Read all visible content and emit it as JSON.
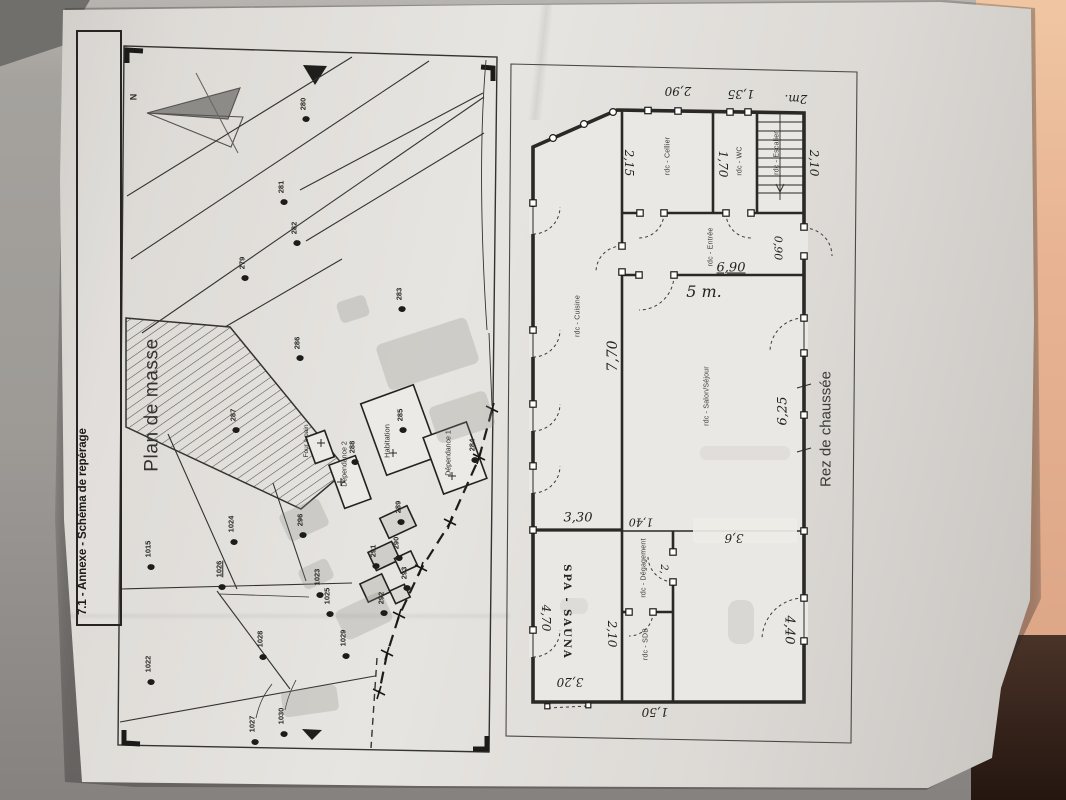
{
  "document": {
    "title": "7.1 - Annexe - Schéma de repérage"
  },
  "site_plan": {
    "title": "Plan de masse",
    "north_label": "N",
    "building_labels": [
      {
        "text": "Four à pain",
        "x": 307,
        "y": 441,
        "size": 6.5
      },
      {
        "text": "Dépendance 2",
        "x": 345,
        "y": 464,
        "size": 7
      },
      {
        "text": "Habitation",
        "x": 387,
        "y": 441,
        "size": 7.5
      },
      {
        "text": "Dépendance 1",
        "x": 449,
        "y": 453,
        "size": 7
      }
    ],
    "parcels": [
      {
        "text": "280",
        "x": 303,
        "y": 104,
        "dot": true
      },
      {
        "text": "281",
        "x": 281,
        "y": 187,
        "dot": true
      },
      {
        "text": "282",
        "x": 294,
        "y": 228,
        "dot": true
      },
      {
        "text": "279",
        "x": 242,
        "y": 263,
        "dot": true
      },
      {
        "text": "283",
        "x": 399,
        "y": 294,
        "dot": true
      },
      {
        "text": "286",
        "x": 297,
        "y": 343,
        "dot": true
      },
      {
        "text": "287",
        "x": 233,
        "y": 415,
        "dot": true
      },
      {
        "text": "285",
        "x": 400,
        "y": 415,
        "dot": true
      },
      {
        "text": "288",
        "x": 352,
        "y": 447,
        "dot": true
      },
      {
        "text": "284",
        "x": 472,
        "y": 445,
        "dot": true
      },
      {
        "text": "296",
        "x": 300,
        "y": 520,
        "dot": true
      },
      {
        "text": "289",
        "x": 398,
        "y": 507,
        "dot": true
      },
      {
        "text": "290",
        "x": 396,
        "y": 543,
        "dot": true
      },
      {
        "text": "291",
        "x": 373,
        "y": 551,
        "dot": true
      },
      {
        "text": "293",
        "x": 404,
        "y": 573,
        "dot": true
      },
      {
        "text": "292",
        "x": 381,
        "y": 598,
        "dot": true
      },
      {
        "text": "1015",
        "x": 148,
        "y": 549,
        "dot": true
      },
      {
        "text": "1024",
        "x": 231,
        "y": 524,
        "dot": true
      },
      {
        "text": "1026",
        "x": 219,
        "y": 569,
        "dot": true,
        "u": true
      },
      {
        "text": "1023",
        "x": 317,
        "y": 577,
        "dot": true
      },
      {
        "text": "1025",
        "x": 327,
        "y": 596,
        "dot": true
      },
      {
        "text": "1028",
        "x": 260,
        "y": 639,
        "dot": true
      },
      {
        "text": "1029",
        "x": 343,
        "y": 638,
        "dot": true
      },
      {
        "text": "1022",
        "x": 148,
        "y": 664,
        "dot": true
      },
      {
        "text": "1030",
        "x": 281,
        "y": 716,
        "dot": true
      },
      {
        "text": "1027",
        "x": 252,
        "y": 724,
        "dot": true
      }
    ]
  },
  "floor_plan": {
    "title": "Rez de chaussée",
    "rooms": [
      {
        "text": "rdc - Cellier",
        "x": 668,
        "y": 156
      },
      {
        "text": "rdc - WC",
        "x": 740,
        "y": 161
      },
      {
        "text": "rdc - Escalier",
        "x": 777,
        "y": 153
      },
      {
        "text": "rdc - Entrée",
        "x": 711,
        "y": 247
      },
      {
        "text": "rdc - Cuisine",
        "x": 578,
        "y": 316
      },
      {
        "text": "rdc - Salon/Séjour",
        "x": 707,
        "y": 396
      },
      {
        "text": "rdc - Dégagement",
        "x": 644,
        "y": 568
      },
      {
        "text": "rdc - SDB",
        "x": 646,
        "y": 644
      }
    ],
    "dimensions": [
      {
        "text": "2m.",
        "x": 796,
        "y": 99,
        "rot": 180,
        "size": 12
      },
      {
        "text": "1,35",
        "x": 741,
        "y": 94,
        "rot": 180,
        "size": 12
      },
      {
        "text": "2,90",
        "x": 678,
        "y": 91,
        "rot": 180,
        "size": 12
      },
      {
        "text": "2,15",
        "x": 629,
        "y": 163,
        "rot": 90,
        "size": 12
      },
      {
        "text": "1,70",
        "x": 723,
        "y": 164,
        "rot": 90,
        "size": 12
      },
      {
        "text": "2,10",
        "x": 814,
        "y": 163,
        "rot": 90,
        "size": 12
      },
      {
        "text": "0,90",
        "x": 778,
        "y": 248,
        "rot": 90,
        "size": 11
      },
      {
        "text": "6,90",
        "x": 731,
        "y": 268,
        "rot": 0,
        "size": 13,
        "u": true
      },
      {
        "text": "5 m.",
        "x": 704,
        "y": 292,
        "rot": 0,
        "size": 16
      },
      {
        "text": "7,70",
        "x": 613,
        "y": 356,
        "rot": -90,
        "size": 14
      },
      {
        "text": "6,25",
        "x": 783,
        "y": 411,
        "rot": -90,
        "size": 13
      },
      {
        "text": "1,40",
        "x": 641,
        "y": 522,
        "rot": 180,
        "size": 11
      },
      {
        "text": "3,6",
        "x": 734,
        "y": 538,
        "rot": 180,
        "size": 12
      },
      {
        "text": "3,30",
        "x": 578,
        "y": 518,
        "rot": 0,
        "size": 13
      },
      {
        "text": "2,",
        "x": 663,
        "y": 569,
        "rot": 90,
        "size": 10
      },
      {
        "text": "4,70",
        "x": 546,
        "y": 618,
        "rot": 90,
        "size": 12
      },
      {
        "text": "SPA - SAUNA",
        "x": 566,
        "y": 612,
        "rot": 90,
        "size": 10,
        "cls": "caps"
      },
      {
        "text": "2,10",
        "x": 612,
        "y": 634,
        "rot": 90,
        "size": 12
      },
      {
        "text": "3,20",
        "x": 570,
        "y": 682,
        "rot": 180,
        "size": 12
      },
      {
        "text": "1,50",
        "x": 655,
        "y": 712,
        "rot": 180,
        "size": 12
      },
      {
        "text": "4,40",
        "x": 789,
        "y": 630,
        "rot": 90,
        "size": 13
      }
    ]
  }
}
